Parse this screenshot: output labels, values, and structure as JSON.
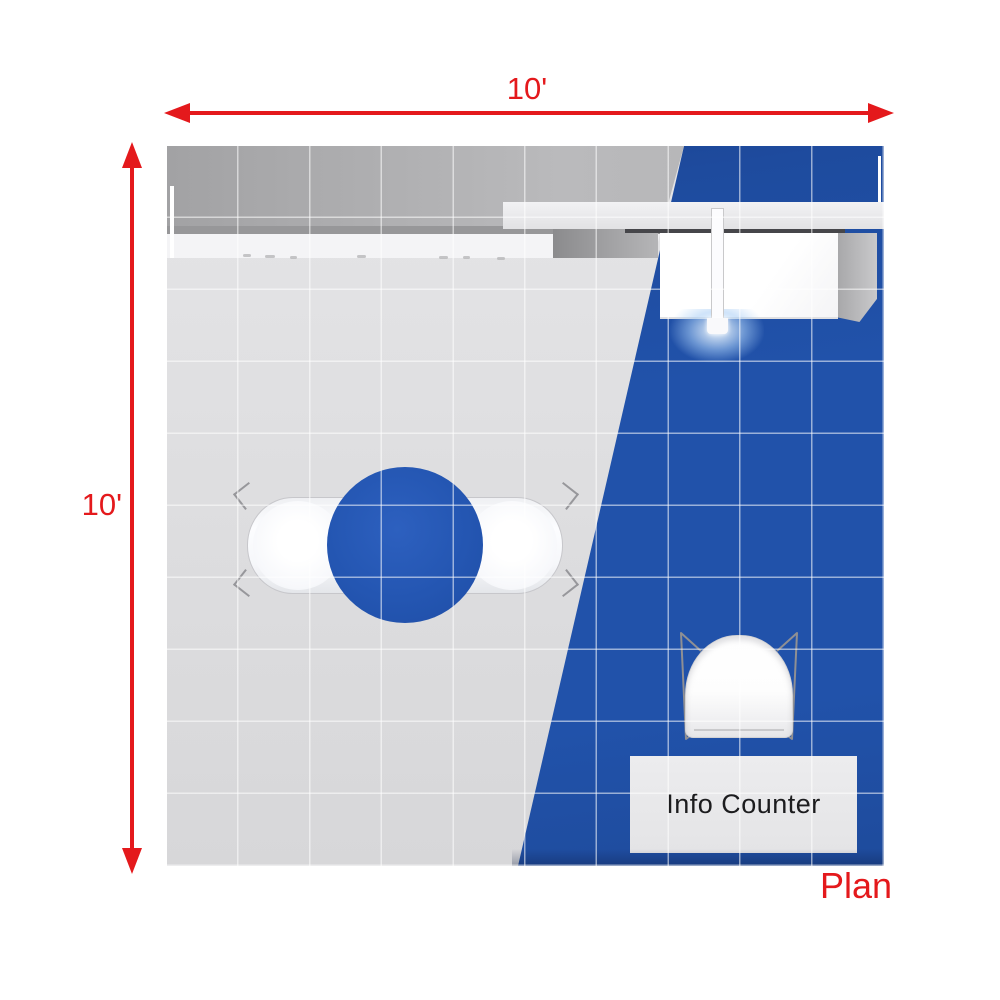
{
  "page": {
    "caption": "Plan",
    "background_color": "#ffffff",
    "accent_red": "#e4191c"
  },
  "dimension_arrows": {
    "top": {
      "label": "10'",
      "direction": "horizontal"
    },
    "left": {
      "label": "10'",
      "direction": "vertical"
    }
  },
  "booth_plan": {
    "size_feet": {
      "width": 10,
      "depth": 10
    },
    "grid": {
      "columns": 10,
      "rows": 10,
      "line_color": "rgba(255,255,255,0.55)"
    },
    "floor": {
      "hard_floor_color": "#dcdcde",
      "carpet_color": "#2152aa"
    },
    "round_table_color": "#2456b2",
    "info_counter": {
      "label": "Info Counter",
      "fill_color": "#e8e8ea",
      "text_color": "#1c1c1e"
    }
  }
}
